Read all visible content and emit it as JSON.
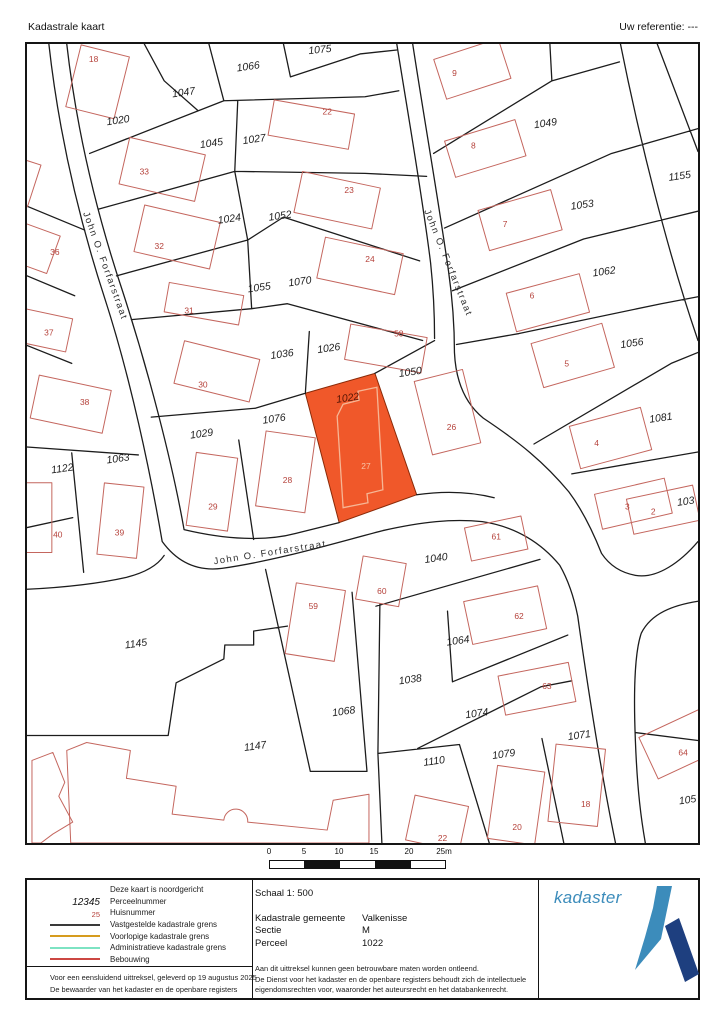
{
  "header": {
    "title": "Kadastrale kaart",
    "reference": "Uw referentie: ---"
  },
  "map": {
    "theme": {
      "highlight_fill": "#f0582a",
      "boundary_color": "#1c1c1c",
      "building_color": "#c4665e",
      "house_number_color": "#b5413a"
    },
    "highlighted": {
      "parcel_number": "1022",
      "house_number": "27"
    },
    "street_labels": [
      {
        "t": "John O. Forfarstraat",
        "x": 76,
        "y": 224,
        "r": 70
      },
      {
        "t": "John O. Forfarstraat",
        "x": 421,
        "y": 221,
        "r": 68
      },
      {
        "t": "John O. Forfarstraat",
        "x": 245,
        "y": 514,
        "r": -9
      }
    ],
    "parcel_labels": [
      {
        "t": "1075",
        "x": 295,
        "y": 9,
        "r": -6
      },
      {
        "t": "1066",
        "x": 223,
        "y": 26,
        "r": -8
      },
      {
        "t": "1047",
        "x": 158,
        "y": 52,
        "r": -8
      },
      {
        "t": "1020",
        "x": 92,
        "y": 80,
        "r": -8
      },
      {
        "t": "1045",
        "x": 186,
        "y": 103,
        "r": -8
      },
      {
        "t": "1027",
        "x": 229,
        "y": 99,
        "r": -8
      },
      {
        "t": "1049",
        "x": 522,
        "y": 83,
        "r": -8
      },
      {
        "t": "1155",
        "x": 657,
        "y": 136,
        "r": -8
      },
      {
        "t": "1053",
        "x": 559,
        "y": 165,
        "r": -8
      },
      {
        "t": "1024",
        "x": 204,
        "y": 179,
        "r": -8
      },
      {
        "t": "1052",
        "x": 255,
        "y": 176,
        "r": -8
      },
      {
        "t": "1062",
        "x": 581,
        "y": 232,
        "r": -8
      },
      {
        "t": "1055",
        "x": 234,
        "y": 248,
        "r": -8
      },
      {
        "t": "1070",
        "x": 275,
        "y": 242,
        "r": -8
      },
      {
        "t": "1036",
        "x": 257,
        "y": 315,
        "r": -8
      },
      {
        "t": "1026",
        "x": 304,
        "y": 309,
        "r": -8
      },
      {
        "t": "1056",
        "x": 609,
        "y": 304,
        "r": -8
      },
      {
        "t": "1050",
        "x": 386,
        "y": 333,
        "r": -8
      },
      {
        "t": "1081",
        "x": 638,
        "y": 379,
        "r": -8
      },
      {
        "t": "1076",
        "x": 249,
        "y": 380,
        "r": -8
      },
      {
        "t": "1029",
        "x": 176,
        "y": 395,
        "r": -8
      },
      {
        "t": "1063",
        "x": 92,
        "y": 420,
        "r": -8
      },
      {
        "t": "1122",
        "x": 36,
        "y": 430,
        "r": -8
      },
      {
        "t": "103",
        "x": 663,
        "y": 463,
        "r": -8
      },
      {
        "t": "1040",
        "x": 412,
        "y": 520,
        "r": -8
      },
      {
        "t": "1064",
        "x": 434,
        "y": 603,
        "r": -8
      },
      {
        "t": "1038",
        "x": 386,
        "y": 642,
        "r": -8
      },
      {
        "t": "1145",
        "x": 110,
        "y": 606,
        "r": -8
      },
      {
        "t": "1068",
        "x": 319,
        "y": 674,
        "r": -8
      },
      {
        "t": "1074",
        "x": 453,
        "y": 676,
        "r": -8
      },
      {
        "t": "1110",
        "x": 410,
        "y": 724,
        "r": -8
      },
      {
        "t": "1079",
        "x": 480,
        "y": 717,
        "r": -8
      },
      {
        "t": "1071",
        "x": 556,
        "y": 698,
        "r": -8
      },
      {
        "t": "1147",
        "x": 230,
        "y": 709,
        "r": -8
      },
      {
        "t": "105",
        "x": 665,
        "y": 763,
        "r": -8
      }
    ],
    "house_labels": [
      {
        "t": "18",
        "x": 67,
        "y": 18
      },
      {
        "t": "9",
        "x": 430,
        "y": 32
      },
      {
        "t": "22",
        "x": 302,
        "y": 71
      },
      {
        "t": "8",
        "x": 449,
        "y": 105
      },
      {
        "t": "33",
        "x": 118,
        "y": 131
      },
      {
        "t": "23",
        "x": 324,
        "y": 150
      },
      {
        "t": "7",
        "x": 481,
        "y": 184
      },
      {
        "t": "32",
        "x": 133,
        "y": 206
      },
      {
        "t": "24",
        "x": 345,
        "y": 219
      },
      {
        "t": "36",
        "x": 28,
        "y": 212
      },
      {
        "t": "6",
        "x": 508,
        "y": 256
      },
      {
        "t": "31",
        "x": 163,
        "y": 271
      },
      {
        "t": "58",
        "x": 374,
        "y": 294
      },
      {
        "t": "5",
        "x": 543,
        "y": 324
      },
      {
        "t": "30",
        "x": 177,
        "y": 345
      },
      {
        "t": "26",
        "x": 427,
        "y": 388
      },
      {
        "t": "4",
        "x": 573,
        "y": 404
      },
      {
        "t": "38",
        "x": 58,
        "y": 363
      },
      {
        "t": "37",
        "x": 22,
        "y": 293
      },
      {
        "t": "3",
        "x": 604,
        "y": 468
      },
      {
        "t": "29",
        "x": 187,
        "y": 468
      },
      {
        "t": "28",
        "x": 262,
        "y": 441
      },
      {
        "t": "61",
        "x": 472,
        "y": 498
      },
      {
        "t": "2",
        "x": 630,
        "y": 473
      },
      {
        "t": "40",
        "x": 31,
        "y": 496
      },
      {
        "t": "39",
        "x": 93,
        "y": 494
      },
      {
        "t": "59",
        "x": 288,
        "y": 568
      },
      {
        "t": "60",
        "x": 357,
        "y": 553
      },
      {
        "t": "62",
        "x": 495,
        "y": 578
      },
      {
        "t": "63",
        "x": 523,
        "y": 648
      },
      {
        "t": "64",
        "x": 660,
        "y": 715
      },
      {
        "t": "18",
        "x": 562,
        "y": 767
      },
      {
        "t": "20",
        "x": 493,
        "y": 790
      },
      {
        "t": "22",
        "x": 418,
        "y": 801
      }
    ],
    "highlight_labels": {
      "parcel": {
        "t": "1022",
        "x": 323,
        "y": 359,
        "r": -8
      },
      "house": {
        "t": "27",
        "x": 341,
        "y": 427,
        "r": 0
      }
    }
  },
  "scalebar": {
    "ticks": [
      "0",
      "5",
      "10",
      "15",
      "20",
      "25m"
    ],
    "segment_colors": [
      "#ffffff",
      "#111111",
      "#ffffff",
      "#111111",
      "#ffffff"
    ]
  },
  "legend": {
    "items": [
      {
        "type": "none",
        "label": "Deze kaart is noordgericht"
      },
      {
        "type": "text",
        "style": "parcel-sample",
        "sample": "12345",
        "label": "Perceelnummer"
      },
      {
        "type": "text",
        "style": "house-sample",
        "sample": "25",
        "label": "Huisnummer"
      },
      {
        "type": "line",
        "color": "#3a3a3a",
        "label": "Vastgestelde kadastrale grens"
      },
      {
        "type": "line",
        "color": "#d69c1e",
        "label": "Voorlopige kadastrale grens"
      },
      {
        "type": "line",
        "color": "#7de3c3",
        "label": "Administratieve kadastrale grens"
      },
      {
        "type": "line",
        "color": "#cc4743",
        "label": "Bebouwing"
      }
    ],
    "schaal": "Schaal 1: 500",
    "fields": [
      {
        "label": "Kadastrale gemeente",
        "value": "Valkenisse"
      },
      {
        "label": "Sectie",
        "value": "M"
      },
      {
        "label": "Perceel",
        "value": "1022"
      }
    ],
    "logo_text": "kadaster",
    "logo_colors": {
      "light": "#3c8cbb",
      "dark": "#1e3f7f"
    }
  },
  "footer": {
    "left_lines": [
      "Voor een eensluidend uittreksel, geleverd op 19 augustus 2025",
      "De bewaarder van het kadaster en de openbare registers"
    ],
    "right_lines": [
      "Aan dit uittreksel kunnen geen betrouwbare maten worden ontleend.",
      "De Dienst voor het kadaster en de openbare registers behoudt zich de intellectuele",
      "eigendomsrechten voor, waaronder het auteursrecht en het databankenrecht."
    ]
  }
}
